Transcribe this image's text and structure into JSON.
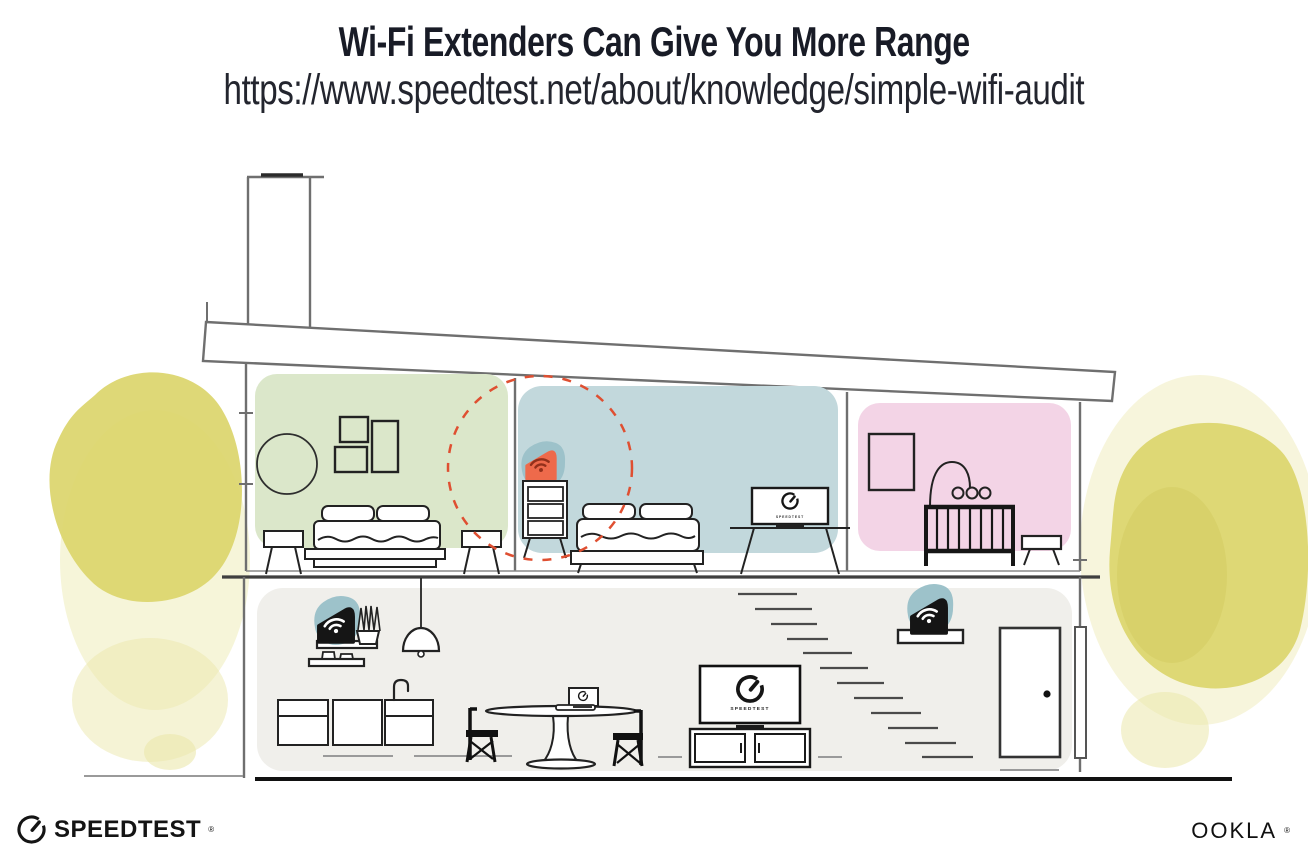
{
  "page": {
    "title": "Wi-Fi Extenders Can Give You More Range",
    "url": "https://www.speedtest.net/about/knowledge/simple-wifi-audit"
  },
  "branding": {
    "speedtest_wordmark": "SPEEDTEST",
    "speedtest_registered": "®",
    "ookla_wordmark": "OOKLA",
    "ookla_registered": "®"
  },
  "illustration": {
    "tv_screen_label": "SPEEDTEST",
    "colors": {
      "bedroom_left_wall": "#dbe7ca",
      "bedroom_middle_wall": "#c2d8dc",
      "nursery_wall": "#f3d4e6",
      "downstairs_wall": "#f0efeb",
      "device_backdrop_teal": "#9dc2ca",
      "extender_highlight_orange": "#ee6a4b",
      "extender_wifi_maroon": "#93301b",
      "range_ring_red": "#df4f31",
      "foliage_yellow": "#dbd56b",
      "foliage_yellow_light": "#ebe8ab",
      "foliage_yellow_dark": "#cfc95a",
      "structure_gray": "#6f6f6f",
      "ink": "#1a1a1a"
    },
    "devices": {
      "upstairs_extender": "wifi-extender-highlighted",
      "downstairs_router": "wifi-router",
      "downstairs_extender": "wifi-extender"
    }
  }
}
